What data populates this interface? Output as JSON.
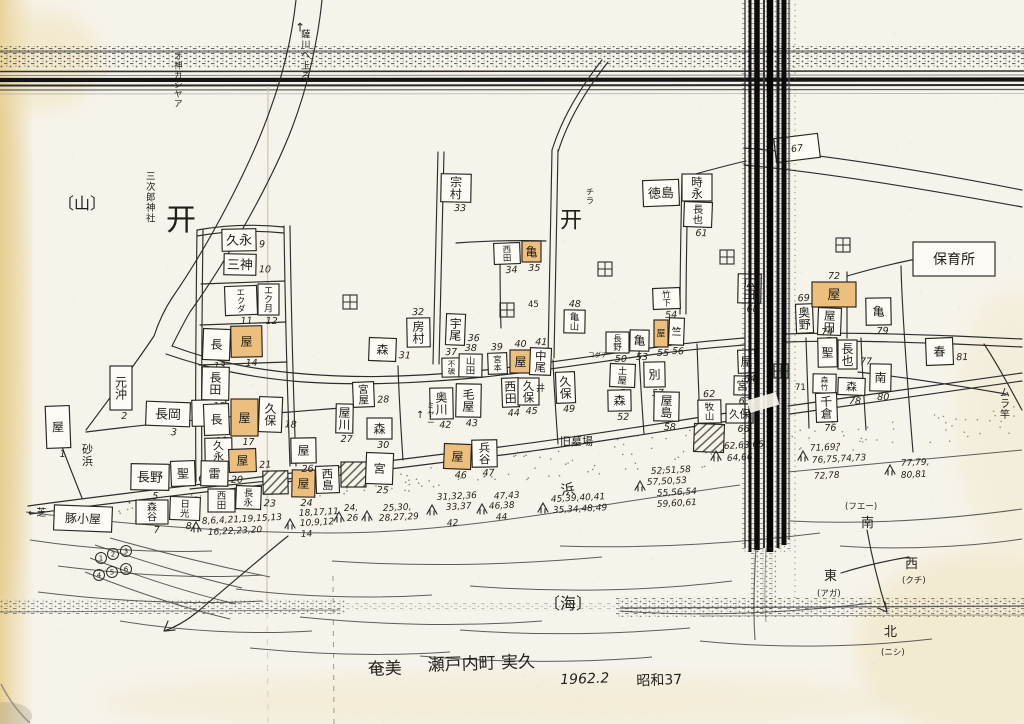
{
  "caption": {
    "region": "奄美",
    "town": "瀬戸内町 実久",
    "date": "1962.2",
    "era": "昭和37"
  },
  "compass": {
    "south": "南",
    "south_dialect": "(フエー)",
    "east": "東",
    "east_dialect": "(アガ)",
    "west": "西",
    "west_dialect": "(クチ)",
    "north": "北",
    "north_dialect": "(ニシ)"
  },
  "colors": {
    "paper": "#f6f3ea",
    "ink": "#2c2c2c",
    "highlight": "#ecbf7e",
    "band": "#0c0c0c"
  },
  "place_labels": [
    {
      "t": "↑",
      "x": 295,
      "y": 22,
      "s": 12
    },
    {
      "t": "薩川ヘ上る",
      "x": 301,
      "y": 30,
      "v": 1,
      "s": 9.5
    },
    {
      "t": "オ神ガシヤア",
      "x": 174,
      "y": 52,
      "v": 1,
      "s": 8.5
    },
    {
      "t": "〔山〕",
      "x": 58,
      "y": 196,
      "s": 16
    },
    {
      "t": "三次郎神社",
      "x": 146,
      "y": 172,
      "v": 1,
      "s": 9.5
    },
    {
      "t": "开",
      "x": 166,
      "y": 206,
      "s": 30
    },
    {
      "t": "开",
      "x": 560,
      "y": 210,
      "s": 22
    },
    {
      "t": "チラ",
      "x": 586,
      "y": 188,
      "v": 1,
      "s": 8
    },
    {
      "t": "砂浜",
      "x": 82,
      "y": 444,
      "v": 1,
      "s": 11
    },
    {
      "t": "←芝",
      "x": 28,
      "y": 508,
      "s": 10
    },
    {
      "t": "浜",
      "x": 560,
      "y": 484,
      "s": 14,
      "rot": -8
    },
    {
      "t": "〔海〕",
      "x": 544,
      "y": 596,
      "s": 16
    },
    {
      "t": "旧墓場",
      "x": 560,
      "y": 436,
      "s": 11
    },
    {
      "t": "井",
      "x": 536,
      "y": 384,
      "s": 9
    },
    {
      "t": "↑",
      "x": 416,
      "y": 410,
      "s": 10
    },
    {
      "t": "ミヤー",
      "x": 427,
      "y": 402,
      "v": 1,
      "s": 7.5
    },
    {
      "t": "ムラ竿",
      "x": 1000,
      "y": 388,
      "v": 1,
      "s": 10
    },
    {
      "t": "コダチ",
      "x": 588,
      "y": 352,
      "s": 6.5
    },
    {
      "t": "45",
      "x": 528,
      "y": 300,
      "s": 8.5
    },
    {
      "t": "71",
      "x": 795,
      "y": 383,
      "s": 8.5
    }
  ],
  "buildings": [
    {
      "x": 46,
      "y": 406,
      "w": 24,
      "h": 42,
      "n": "屋",
      "num": "1",
      "np": "b"
    },
    {
      "x": 110,
      "y": 366,
      "w": 22,
      "h": 44,
      "n": "元沖",
      "num": "2",
      "np": "b"
    },
    {
      "x": 146,
      "y": 402,
      "w": 44,
      "h": 24,
      "n": "長岡",
      "num": "3",
      "np": "b"
    },
    {
      "x": 192,
      "y": 400,
      "w": 34,
      "h": 26,
      "n": "安",
      "num": "4",
      "np": "b"
    },
    {
      "x": 131,
      "y": 464,
      "w": 38,
      "h": 26,
      "n": "長野",
      "num": "5",
      "np": "b"
    },
    {
      "x": 171,
      "y": 461,
      "w": 24,
      "h": 25,
      "n": "聖",
      "num": "6",
      "np": "r"
    },
    {
      "x": 136,
      "y": 500,
      "w": 32,
      "h": 24,
      "n": "森谷",
      "num": "7",
      "np": "b"
    },
    {
      "x": 170,
      "y": 497,
      "w": 30,
      "h": 23,
      "n": "日光",
      "num": "8",
      "np": "b"
    },
    {
      "x": 222,
      "y": 229,
      "w": 34,
      "h": 22,
      "n": "久永",
      "num": "9",
      "np": "r"
    },
    {
      "x": 224,
      "y": 254,
      "w": 32,
      "h": 21,
      "n": "三神",
      "num": "10",
      "np": "r"
    },
    {
      "x": 225,
      "y": 286,
      "w": 32,
      "h": 29,
      "n": "エクダ",
      "num": "11",
      "np": "b"
    },
    {
      "x": 258,
      "y": 284,
      "w": 21,
      "h": 31,
      "n": "エク月",
      "num": "12",
      "np": "b"
    },
    {
      "x": 203,
      "y": 329,
      "w": 27,
      "h": 31,
      "n": "長",
      "num": "13",
      "np": "b"
    },
    {
      "x": 231,
      "y": 326,
      "w": 31,
      "h": 31,
      "n": "屋",
      "num": "14",
      "np": "b",
      "f": "o"
    },
    {
      "x": 202,
      "y": 367,
      "w": 27,
      "h": 33,
      "n": "長田",
      "num": "15",
      "np": "b"
    },
    {
      "x": 204,
      "y": 404,
      "w": 25,
      "h": 31,
      "n": "長",
      "num": "16",
      "np": "b"
    },
    {
      "x": 231,
      "y": 399,
      "w": 27,
      "h": 37,
      "n": "屋",
      "num": "17",
      "np": "b",
      "f": "o"
    },
    {
      "x": 259,
      "y": 397,
      "w": 23,
      "h": 35,
      "n": "久保",
      "num": "18",
      "np": "r"
    },
    {
      "x": 205,
      "y": 438,
      "w": 27,
      "h": 26,
      "n": "久永",
      "num": "19",
      "np": "r"
    },
    {
      "x": 201,
      "y": 461,
      "w": 27,
      "h": 25,
      "n": "雷",
      "num": "20",
      "np": "r"
    },
    {
      "x": 229,
      "y": 449,
      "w": 27,
      "h": 23,
      "n": "屋",
      "num": "21",
      "np": "r",
      "f": "o"
    },
    {
      "x": 208,
      "y": 489,
      "w": 27,
      "h": 23,
      "n": "西田",
      "num": "22",
      "np": "r"
    },
    {
      "x": 236,
      "y": 486,
      "w": 25,
      "h": 23,
      "n": "長永",
      "num": "23",
      "np": "r"
    },
    {
      "x": 263,
      "y": 471,
      "w": 25,
      "h": 23,
      "f": "x"
    },
    {
      "x": 292,
      "y": 470,
      "w": 23,
      "h": 27,
      "n": "屋",
      "num": "24",
      "np": "b",
      "f": "o"
    },
    {
      "x": 316,
      "y": 466,
      "w": 23,
      "h": 27,
      "n": "西島"
    },
    {
      "x": 341,
      "y": 462,
      "w": 25,
      "h": 25,
      "f": "x"
    },
    {
      "x": 366,
      "y": 453,
      "w": 27,
      "h": 31,
      "n": "宮",
      "num": "25",
      "np": "b"
    },
    {
      "x": 291,
      "y": 438,
      "w": 25,
      "h": 25,
      "n": "屋",
      "num": "26",
      "np": "b"
    },
    {
      "x": 336,
      "y": 404,
      "w": 17,
      "h": 29,
      "n": "屋川",
      "num": "27",
      "np": "b"
    },
    {
      "x": 353,
      "y": 382,
      "w": 21,
      "h": 25,
      "n": "宮屋",
      "num": "28",
      "np": "r"
    },
    {
      "x": 367,
      "y": 418,
      "w": 25,
      "h": 21,
      "n": "森",
      "num": "30",
      "np": "b"
    },
    {
      "x": 369,
      "y": 338,
      "w": 27,
      "h": 23,
      "n": "森",
      "num": "31",
      "np": "r"
    },
    {
      "x": 407,
      "y": 318,
      "w": 23,
      "h": 29,
      "n": "房村",
      "num": "32",
      "np": "t"
    },
    {
      "x": 441,
      "y": 174,
      "w": 30,
      "h": 28,
      "n": "宗村",
      "num": "33",
      "np": "b"
    },
    {
      "x": 494,
      "y": 243,
      "w": 26,
      "h": 21,
      "n": "西田",
      "num": "34",
      "np": "b"
    },
    {
      "x": 522,
      "y": 241,
      "w": 19,
      "h": 21,
      "n": "亀",
      "num": "35",
      "np": "b",
      "f": "o"
    },
    {
      "x": 446,
      "y": 314,
      "w": 19,
      "h": 31,
      "n": "宇尾",
      "num": "36",
      "np": "r"
    },
    {
      "x": 442,
      "y": 358,
      "w": 19,
      "h": 19,
      "n": "不破",
      "num": "37",
      "np": "t"
    },
    {
      "x": 459,
      "y": 354,
      "w": 23,
      "h": 23,
      "n": "山田",
      "num": "38",
      "np": "t"
    },
    {
      "x": 488,
      "y": 353,
      "w": 19,
      "h": 21,
      "n": "宮本",
      "num": "39",
      "np": "t"
    },
    {
      "x": 510,
      "y": 350,
      "w": 21,
      "h": 23,
      "n": "屋",
      "num": "40",
      "np": "t",
      "f": "o"
    },
    {
      "x": 530,
      "y": 348,
      "w": 21,
      "h": 27,
      "n": "中尾",
      "num": "41",
      "np": "t"
    },
    {
      "x": 430,
      "y": 388,
      "w": 23,
      "h": 31,
      "n": "奥川",
      "num": "42",
      "np": "b"
    },
    {
      "x": 456,
      "y": 384,
      "w": 25,
      "h": 33,
      "n": "毛屋",
      "num": "43",
      "np": "b"
    },
    {
      "x": 502,
      "y": 378,
      "w": 17,
      "h": 29,
      "n": "西田",
      "num": "44",
      "np": "b"
    },
    {
      "x": 518,
      "y": 378,
      "w": 21,
      "h": 27,
      "n": "久保",
      "num": "45",
      "np": "b"
    },
    {
      "x": 444,
      "y": 444,
      "w": 27,
      "h": 25,
      "n": "屋",
      "num": "46",
      "np": "b",
      "f": "o"
    },
    {
      "x": 472,
      "y": 440,
      "w": 25,
      "h": 27,
      "n": "兵谷",
      "num": "47",
      "np": "b"
    },
    {
      "x": 564,
      "y": 310,
      "w": 21,
      "h": 23,
      "n": "亀山",
      "num": "48",
      "np": "t"
    },
    {
      "x": 556,
      "y": 372,
      "w": 19,
      "h": 31,
      "n": "久保",
      "num": "49",
      "np": "b"
    },
    {
      "x": 606,
      "y": 332,
      "w": 23,
      "h": 21,
      "n": "長野",
      "num": "50",
      "np": "b"
    },
    {
      "x": 610,
      "y": 364,
      "w": 25,
      "h": 23,
      "n": "土屋",
      "num": "51",
      "np": "b"
    },
    {
      "x": 608,
      "y": 390,
      "w": 23,
      "h": 21,
      "n": "森",
      "num": "52",
      "np": "b"
    },
    {
      "x": 630,
      "y": 330,
      "w": 19,
      "h": 21,
      "n": "亀",
      "num": "53",
      "np": "b"
    },
    {
      "x": 653,
      "y": 288,
      "w": 27,
      "h": 21,
      "n": "竹下",
      "num": "54",
      "np": "b"
    },
    {
      "x": 654,
      "y": 320,
      "w": 14,
      "h": 27,
      "n": "屋",
      "num": "55",
      "np": "b",
      "f": "o"
    },
    {
      "x": 669,
      "y": 318,
      "w": 15,
      "h": 27,
      "n": "竺",
      "num": "56",
      "np": "b"
    },
    {
      "x": 644,
      "y": 362,
      "w": 21,
      "h": 25,
      "n": "別",
      "num": "57",
      "np": "b"
    },
    {
      "x": 654,
      "y": 392,
      "w": 25,
      "h": 29,
      "n": "屋島",
      "num": "58",
      "np": "b"
    },
    {
      "x": 643,
      "y": 180,
      "w": 36,
      "h": 26,
      "n": "徳島",
      "num": "59",
      "np": "r"
    },
    {
      "x": 682,
      "y": 174,
      "w": 30,
      "h": 27,
      "n": "時永",
      "num": "60",
      "np": "b"
    },
    {
      "x": 684,
      "y": 202,
      "w": 28,
      "h": 25,
      "n": "長也",
      "num": "61",
      "np": "b"
    },
    {
      "x": 698,
      "y": 400,
      "w": 23,
      "h": 23,
      "n": "牧山",
      "num": "62",
      "np": "t"
    },
    {
      "x": 734,
      "y": 376,
      "w": 17,
      "h": 19,
      "n": "宮",
      "num": "63",
      "np": "b"
    },
    {
      "x": 738,
      "y": 350,
      "w": 17,
      "h": 23,
      "n": "屋",
      "num": "64",
      "np": "b"
    },
    {
      "x": 726,
      "y": 404,
      "w": 27,
      "h": 19,
      "n": "久保",
      "num": "66",
      "np": "b"
    },
    {
      "x": 694,
      "y": 424,
      "w": 30,
      "h": 28,
      "f": "x"
    },
    {
      "x": 775,
      "y": 136,
      "w": 44,
      "h": 24,
      "num": "67",
      "np": "in",
      "rot": -7
    },
    {
      "x": 738,
      "y": 274,
      "w": 23,
      "h": 29,
      "n": "広田",
      "num": "68",
      "np": "b"
    },
    {
      "x": 796,
      "y": 304,
      "w": 17,
      "h": 29,
      "n": "奥野",
      "num": "69",
      "np": "t"
    },
    {
      "x": 812,
      "y": 282,
      "w": 44,
      "h": 25,
      "n": "屋",
      "num": "72",
      "np": "t",
      "f": "o"
    },
    {
      "x": 818,
      "y": 308,
      "w": 23,
      "h": 27,
      "n": "屋田",
      "num": "73",
      "np": "b"
    },
    {
      "x": 818,
      "y": 338,
      "w": 19,
      "h": 29,
      "n": "聖",
      "num": "74",
      "np": "t"
    },
    {
      "x": 813,
      "y": 374,
      "w": 23,
      "h": 19,
      "n": "森竹",
      "num": "75",
      "np": "r"
    },
    {
      "x": 816,
      "y": 393,
      "w": 21,
      "h": 29,
      "n": "千倉",
      "num": "76",
      "np": "b"
    },
    {
      "x": 838,
      "y": 340,
      "w": 19,
      "h": 29,
      "n": "長也",
      "num": "77",
      "np": "r"
    },
    {
      "x": 838,
      "y": 378,
      "w": 27,
      "h": 17,
      "n": "森",
      "num": "78",
      "np": "b"
    },
    {
      "x": 866,
      "y": 298,
      "w": 25,
      "h": 27,
      "n": "亀",
      "num": "79",
      "np": "b"
    },
    {
      "x": 870,
      "y": 364,
      "w": 21,
      "h": 27,
      "n": "南",
      "num": "80",
      "np": "b"
    },
    {
      "x": 926,
      "y": 338,
      "w": 27,
      "h": 27,
      "n": "春",
      "num": "81",
      "np": "r"
    },
    {
      "x": 913,
      "y": 242,
      "w": 82,
      "h": 34,
      "n": "保育所",
      "horiz": 1,
      "s": 14
    },
    {
      "x": 54,
      "y": 506,
      "w": 58,
      "h": 25,
      "n": "豚小屋",
      "horiz": 1,
      "s": 12
    }
  ],
  "paddy_fields": [
    [
      343,
      295
    ],
    [
      500,
      303
    ],
    [
      598,
      262
    ],
    [
      720,
      250
    ],
    [
      774,
      364
    ],
    [
      836,
      238
    ]
  ],
  "number_groups": [
    {
      "t": "8,6,4,21,19,15,13",
      "x": 202,
      "y": 524
    },
    {
      "t": "16,22,23,20",
      "x": 208,
      "y": 535
    },
    {
      "t": "18,17,11",
      "x": 299,
      "y": 516
    },
    {
      "t": "10,9,12",
      "x": 300,
      "y": 526
    },
    {
      "t": "14",
      "x": 301,
      "y": 537
    },
    {
      "t": "24,",
      "x": 344,
      "y": 511
    },
    {
      "t": "26",
      "x": 347,
      "y": 521
    },
    {
      "t": "25,30,",
      "x": 383,
      "y": 511
    },
    {
      "t": "28,27,29",
      "x": 379,
      "y": 521
    },
    {
      "t": "31,32,36",
      "x": 437,
      "y": 500
    },
    {
      "t": "33,37",
      "x": 446,
      "y": 510
    },
    {
      "t": "42",
      "x": 447,
      "y": 526
    },
    {
      "t": "47,43",
      "x": 494,
      "y": 499
    },
    {
      "t": "46,38",
      "x": 489,
      "y": 509
    },
    {
      "t": "44",
      "x": 496,
      "y": 520
    },
    {
      "t": "45,39,40,41",
      "x": 551,
      "y": 502
    },
    {
      "t": "35,34,48,49",
      "x": 553,
      "y": 513
    },
    {
      "t": "52,51,58",
      "x": 651,
      "y": 474
    },
    {
      "t": "57,50,53",
      "x": 647,
      "y": 485
    },
    {
      "t": "55,56,54",
      "x": 657,
      "y": 496
    },
    {
      "t": "59,60,61",
      "x": 657,
      "y": 507
    },
    {
      "t": "62,63,65",
      "x": 724,
      "y": 449
    },
    {
      "t": "64,66",
      "x": 727,
      "y": 461
    },
    {
      "t": "71,69?",
      "x": 810,
      "y": 451
    },
    {
      "t": "76,75,74,73",
      "x": 812,
      "y": 463
    },
    {
      "t": "72,78",
      "x": 814,
      "y": 479
    },
    {
      "t": "77,79,",
      "x": 901,
      "y": 466
    },
    {
      "t": "80,81",
      "x": 901,
      "y": 478
    }
  ],
  "arrow_marks": [
    [
      196,
      527
    ],
    [
      290,
      524
    ],
    [
      339,
      517
    ],
    [
      367,
      516
    ],
    [
      432,
      510
    ],
    [
      482,
      509
    ],
    [
      543,
      508
    ],
    [
      640,
      486
    ],
    [
      716,
      456
    ],
    [
      803,
      456
    ],
    [
      890,
      470
    ]
  ],
  "circled_marks": [
    {
      "x": 101,
      "y": 558,
      "d": "1"
    },
    {
      "x": 113,
      "y": 554,
      "d": "2"
    },
    {
      "x": 126,
      "y": 551,
      "d": "3"
    },
    {
      "x": 99,
      "y": 575,
      "d": "4"
    },
    {
      "x": 112,
      "y": 572,
      "d": "5"
    },
    {
      "x": 126,
      "y": 569,
      "d": "6"
    }
  ]
}
